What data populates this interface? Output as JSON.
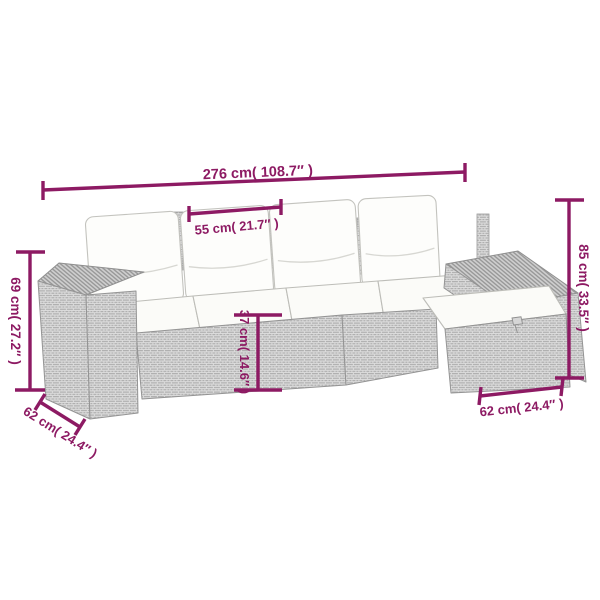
{
  "colors": {
    "dimension_accent": "#8D1A63",
    "wicker_fill": "#DCDCDC",
    "wicker_line": "#A9A9A9",
    "wicker_top_fill": "#CFCFCF",
    "cushion_fill": "#FCFCFA",
    "background": "#FFFFFF"
  },
  "dimensions": {
    "total_width": {
      "label": "276 cm( 108.7″ )"
    },
    "seat_width": {
      "label": "55 cm( 21.7″ )"
    },
    "total_height": {
      "label": "85 cm( 33.5″ )"
    },
    "armrest_height": {
      "label": "69 cm( 27.2″ )"
    },
    "depth_left": {
      "label": "62 cm( 24.4″ )"
    },
    "seat_height": {
      "label": "37 cm( 14.6″ )"
    },
    "depth_right": {
      "label": "62 cm( 24.4″ )"
    }
  }
}
